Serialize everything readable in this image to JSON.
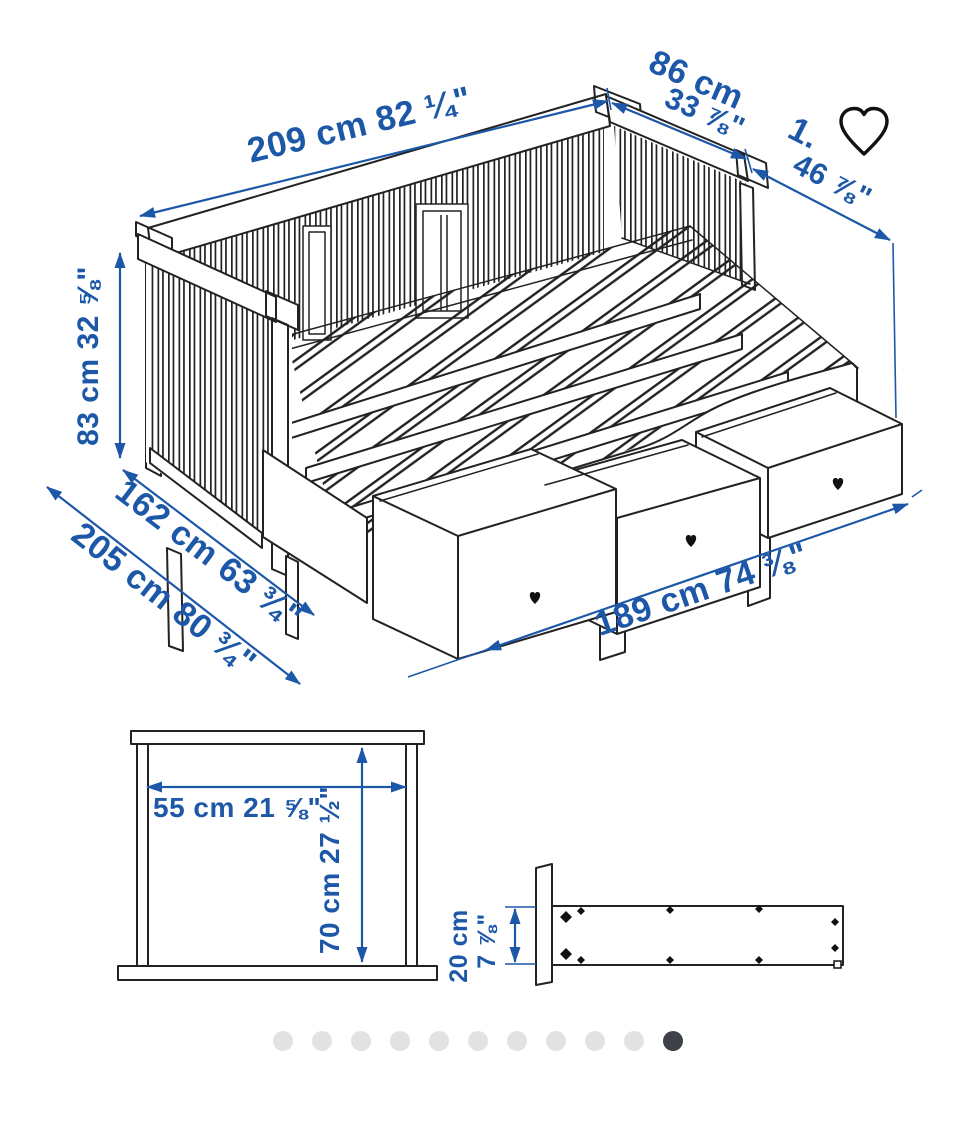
{
  "diagram": {
    "dimensions": {
      "length_top": "209 cm 82 ¼\"",
      "depth_top_cm": "86 cm",
      "depth_top_in": "33 ⅞\"",
      "pullout_line1": "1.",
      "pullout_line2": "46 ⅞\"",
      "height_left": "83 cm 32 ⅝\"",
      "width_extended": "162 cm 63 ¾\"",
      "width_total": "205 cm 80 ¾\"",
      "drawer_span": "189 cm 74 ⅜\""
    },
    "drawer_front_view": {
      "width": "55 cm 21 ⅝\"",
      "height": "70 cm 27 ½\""
    },
    "drawer_side_view": {
      "height_cm": "20 cm",
      "height_in": "7 ⅞\""
    }
  },
  "colors": {
    "dimension_blue": "#1d58a8",
    "line_art": "#222222",
    "dot_inactive": "#e2e2e2",
    "dot_active": "#3e4247",
    "icon_black": "#111111"
  },
  "icons": {
    "favorite": "heart-outline-icon"
  },
  "carousel": {
    "count": 11,
    "active_index": 10
  }
}
